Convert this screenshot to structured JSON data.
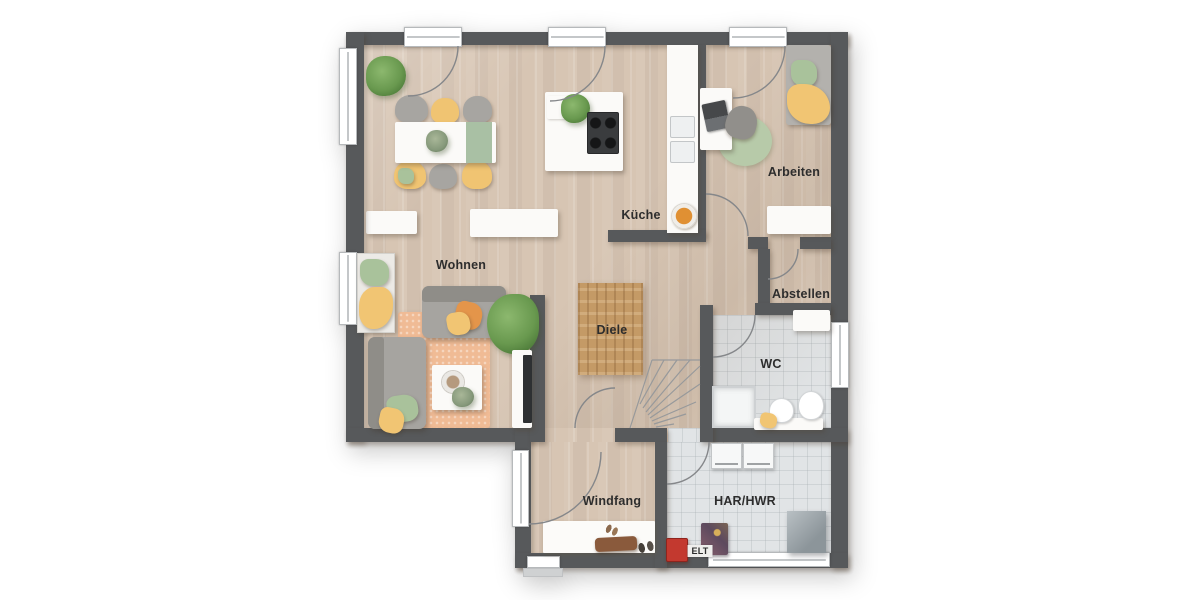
{
  "rooms": {
    "wohnen": {
      "label": "Wohnen"
    },
    "kueche": {
      "label": "Küche"
    },
    "arbeiten": {
      "label": "Arbeiten"
    },
    "abstellen": {
      "label": "Abstellen"
    },
    "diele": {
      "label": "Diele"
    },
    "wc": {
      "label": "WC"
    },
    "windfang": {
      "label": "Windfang"
    },
    "har_hwr": {
      "label": "HAR/HWR"
    },
    "elt": {
      "label": "ELT"
    }
  },
  "colors": {
    "wall": "#57595b",
    "wood_floor": "#d6c5b4",
    "tile_floor": "#e1e4e6",
    "rug_brown": "#c49a66",
    "rug_salmon": "#f0bb95",
    "accent_yellow": "#f1c573",
    "accent_green": "#a9c29b",
    "accent_orange": "#e4954a",
    "elt_red": "#c3392f",
    "label_text": "#2d2d2d"
  }
}
